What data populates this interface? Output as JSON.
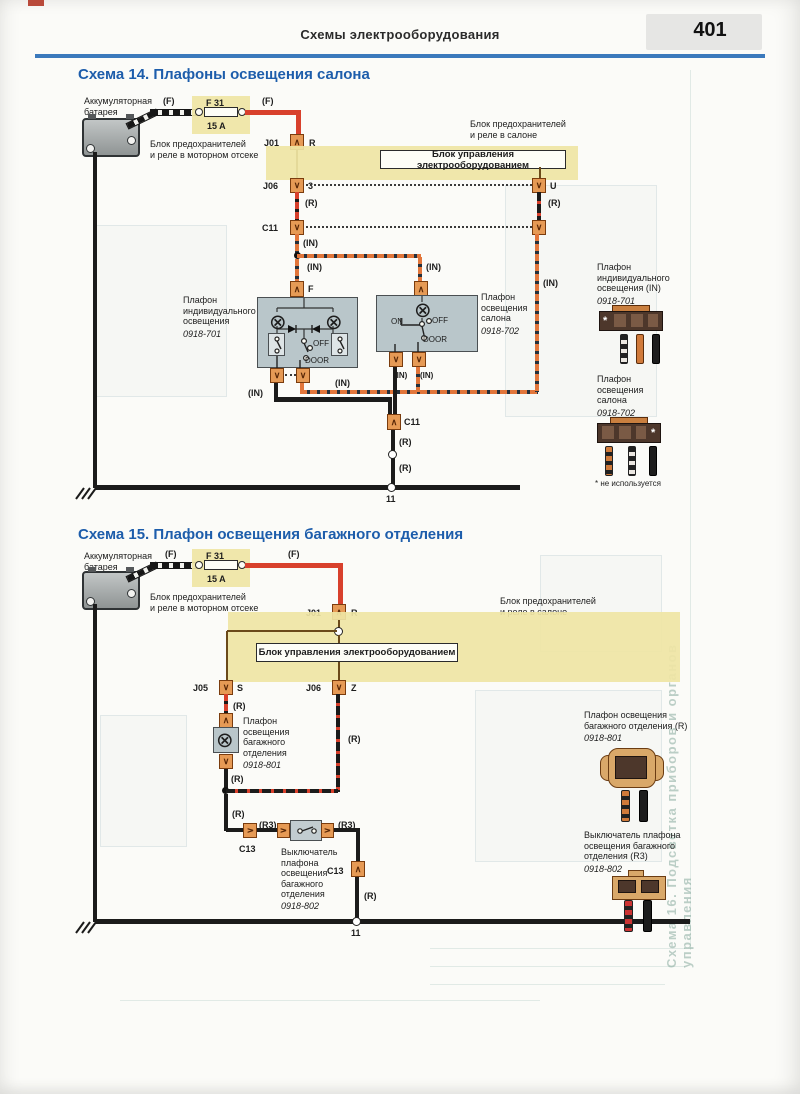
{
  "page": {
    "header": "Схемы электрооборудования",
    "page_number": "401"
  },
  "wire": {
    "f": "(F)",
    "r": "(R)",
    "r3": "(R3)",
    "in": "(IN)"
  },
  "common": {
    "battery": "Аккумуляторная\nбатарея",
    "fuse_name": "F 31",
    "fuse_rating": "15 A",
    "engine_fusebox": "Блок предохранителей\nи реле в моторном отсеке",
    "cabin_fusebox": "Блок предохранителей\nи реле в салоне",
    "control_unit": "Блок управления электрооборудованием",
    "ground_node": "11"
  },
  "icons": {
    "lamp": "⊗",
    "star": "*"
  },
  "schema14": {
    "title": "Схема 14. Плафоны освещения салона",
    "j01": "J01",
    "j01_pin": "R",
    "j06": "J06",
    "j06_pin": "3",
    "u_pin": "U",
    "c11": "C11",
    "f_pin": "F",
    "on": "ON",
    "off": "OFF",
    "door": "DOOR",
    "lamp1_name": "Плафон\nиндивидуального\nосвещения",
    "lamp1_code": "0918-701",
    "lamp2_name": "Плафон\nосвещения\nсалона",
    "lamp2_code": "0918-702",
    "legend1_name": "Плафон\nиндивидуального\nосвещения (IN)",
    "legend1_code": "0918-701",
    "legend2_name": "Плафон\nосвещения\nсалона",
    "legend2_code": "0918-702",
    "footnote": "* не используется"
  },
  "schema15": {
    "title": "Схема 15. Плафон освещения багажного отделения",
    "j01": "J01",
    "j01_pin": "R",
    "j05": "J05",
    "j05_pin": "S",
    "j06": "J06",
    "j06_pin": "Z",
    "c13": "C13",
    "lamp_name": "Плафон\nосвещения\nбагажного\nотделения",
    "lamp_code": "0918-801",
    "switch_name": "Выключатель\nплафона\nосвещения\nбагажного\nотделения",
    "switch_code": "0918-802",
    "legend1_name": "Плафон освещения\nбагажного отделения (R)",
    "legend1_code": "0918-801",
    "legend2_name": "Выключатель плафона\nосвещения багажного\nотделения (R3)",
    "legend2_code": "0918-802"
  },
  "bleed_text": "Схема 16. Подсветка приборов и органов управления"
}
